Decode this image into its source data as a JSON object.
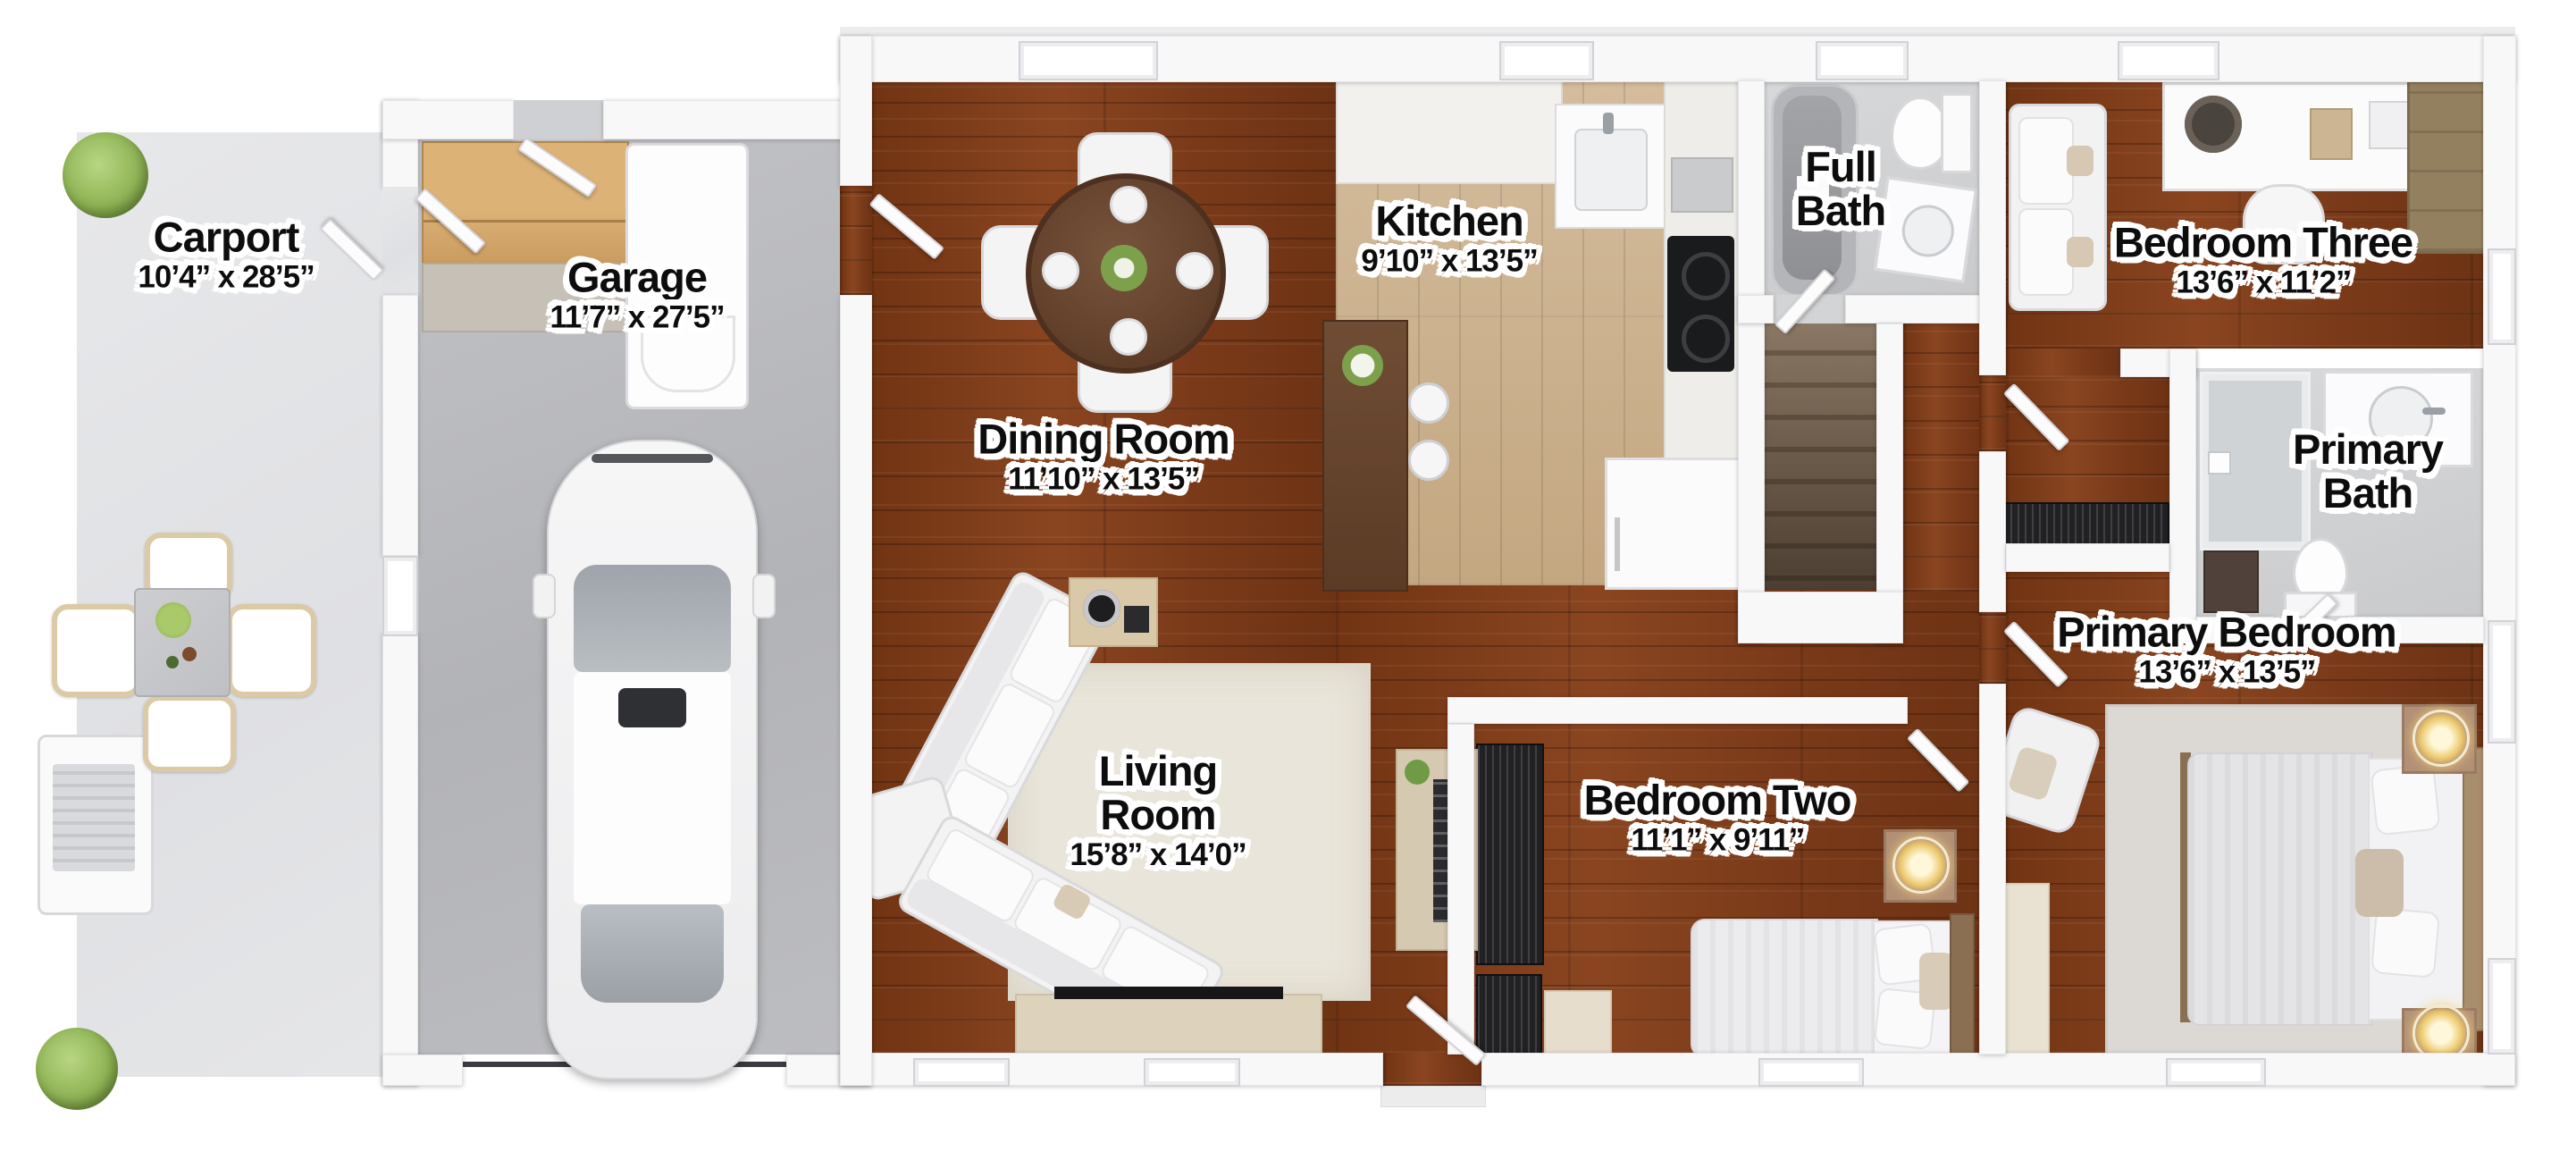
{
  "rooms": [
    {
      "id": "carport",
      "name": "Carport",
      "dims": "10’4” x 28’5”"
    },
    {
      "id": "garage",
      "name": "Garage",
      "dims": "11’7” x 27’5”"
    },
    {
      "id": "dining-room",
      "name": "Dining Room",
      "dims": "11’10” x 13’5”"
    },
    {
      "id": "kitchen",
      "name": "Kitchen",
      "dims": "9’10” x 13’5”"
    },
    {
      "id": "full-bath",
      "name": "Full Bath"
    },
    {
      "id": "bedroom-three",
      "name": "Bedroom Three",
      "dims": "13’6” x 11’2”"
    },
    {
      "id": "primary-bath",
      "name": "Primary Bath"
    },
    {
      "id": "primary-bedroom",
      "name": "Primary Bedroom",
      "dims": "13’6” x 13’5”"
    },
    {
      "id": "living-room",
      "name": "Living Room",
      "dims": "15’8” x 14’0”"
    },
    {
      "id": "bedroom-two",
      "name": "Bedroom Two",
      "dims": "11’1” x 9’11”"
    }
  ],
  "palette": {
    "hardwood": "#7c3a1a",
    "kitchen_floor": "#cbb08e",
    "garage_concrete": "#b9bbbe",
    "carport_concrete": "#e4e5e7",
    "bath_tile": "#d3d4d6",
    "wall": "#f8f8f9",
    "label_text": "#0d0d0d",
    "plant_green": "#8fb455",
    "lamp_glow": "#ecca6f"
  }
}
